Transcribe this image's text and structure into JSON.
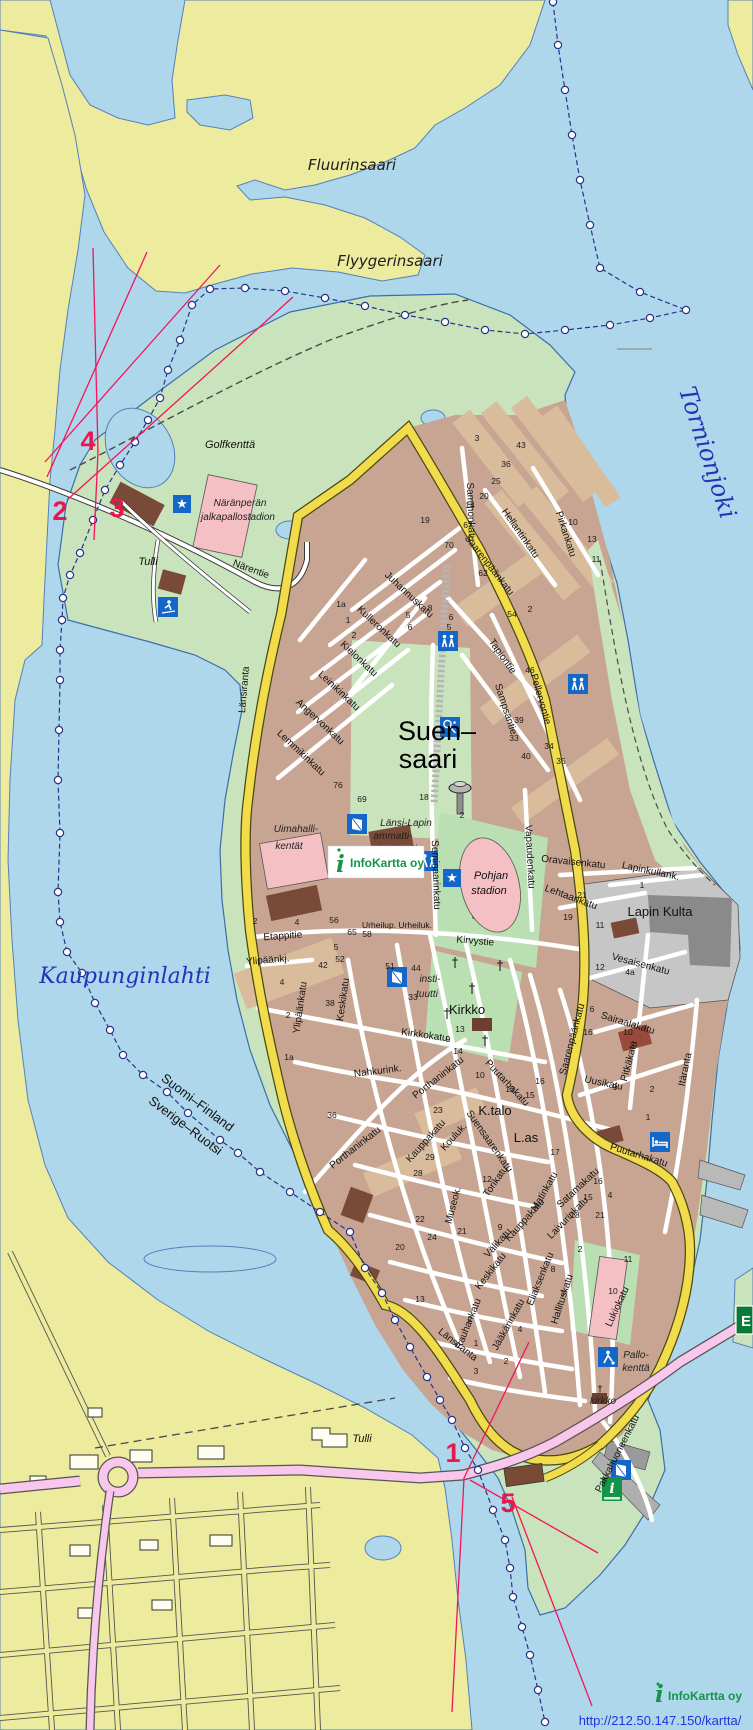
{
  "colors": {
    "water": "#aed7eb",
    "land": "#eceb9e",
    "forest": "#c9e3bd",
    "urban": "#c8a593",
    "urban_tan": "#d9bc9c",
    "building": "#7a4a38",
    "road_yellow": "#f2dc4c",
    "road_pink": "#f9c6ec",
    "marker_magenta": "#e8174f",
    "border_blue": "#27348b",
    "water_label_blue": "#2433b8",
    "logo_green": "#149447",
    "sign_green": "#0a7a38",
    "red_line": "#f4145a",
    "stadium_pink": "#f5c0c4",
    "industry_gray": "#c6c6c6"
  },
  "places": {
    "fluurinsaari": "Fluurinsaari",
    "flyygerinsaari": "Flyygerinsaari",
    "tornionjoki": "Tornionjoki",
    "kaupunginlahti": "Kaupunginlahti",
    "golfkentta": "Golfkenttä",
    "suensaari1": "Suen–",
    "suensaari2": "saari",
    "lapinkulta": "Lapin Kulta",
    "tulli": "Tulli",
    "kirkko": "Kirkko",
    "kirkko_small": "kirkko",
    "kentat1": "Uimahalli-",
    "kentat2": "kentät",
    "naranperan1": "Näränperän",
    "naranperan2": "jalkapallostadion",
    "pohjan1": "Pohjan",
    "pohjan2": "stadion",
    "inst1": "Länsi-Lapin",
    "inst2": "ammatti-",
    "inst3": "instituutti",
    "inst2a": "insti-",
    "inst2b": "tuutti",
    "ktalo": "K.talo",
    "las": "L.as",
    "pallo1": "Pallo-",
    "pallo2": "kenttä"
  },
  "streets": {
    "narentie": "Närentie",
    "sammonkatu": "Sammonkatu",
    "pirkankatu": "Pirkankatu",
    "hellantinkatu": "Hellantinkatu",
    "saarenpaankatu": "Saarenpäänkatu",
    "juhannuskatu": "Juhannuskatu",
    "kulleronkatu": "Kulleronkatu",
    "kielonkatu": "Kielonkatu",
    "leinikinkatu": "Leinikinkatu",
    "angervonkatu": "Angervonkatu",
    "lemmikinkatu": "Lemmikinkatu",
    "lansiranta": "Länsiranta",
    "tapiontie": "Tapiontie",
    "sampsantie": "Sampsantie",
    "pellervontie": "Pellervontie",
    "vapaudenkatu": "Vapaudenkatu",
    "seminaarinkatu": "Seminaarinkatu",
    "oravaisenkatu": "Oravaisenkatu",
    "lapinkullank": "Lapinkullank.",
    "lehtaankatu": "Lehtaankatu",
    "vesaisenkatu": "Vesaisenkatu",
    "sairaalakatu": "Sairaalakatu",
    "pitkakatu": "Pitkäkatu",
    "uusikatu": "Uusikatu",
    "itaranta": "Itäranta",
    "puutarhakatu": "Puutarhakatu",
    "kirvystie": "Kirvystie",
    "etappitie": "Etappitie",
    "ylipaankj": "Ylipäänkj.",
    "ylipaankatu": "Ylipäänkatu",
    "keskikatu": "Keskikatu",
    "kirkkokatu": "Kirkkokatu",
    "nahkurink": "Nahkurink.",
    "porthaninkatu": "Porthaninkatu",
    "kauppakatu": "Kauppakatu",
    "kouluk": "Kouluk.",
    "suensaarenkatu": "Suensaarenkatu",
    "torikatu": "Torikatu",
    "museok": "Museok.",
    "valikatu": "Välikatu",
    "eliaksenkatu": "Eliaksenkatu",
    "hallituskatu": "Hallituskatu",
    "lukiokatu": "Lukiokatu",
    "rauhankatu": "Rauhankatu",
    "jaakarinkatu": "Jääkärinkatu",
    "satamakatu": "Satamakatu",
    "laivurinkatu": "Laivurinkatu",
    "matinkatu": "Matinkatu",
    "pakkahuoneenkatu": "Pakkahuoneenkatu",
    "urheiluk": "Urheilup. Urheiluk."
  },
  "markers": {
    "m1": "1",
    "m2": "2",
    "m3": "3",
    "m4": "4",
    "m5": "5"
  },
  "border": {
    "line1": "Suomi–Finland",
    "line2": "Sverige–Ruotsi"
  },
  "signs": {
    "e_road": "E"
  },
  "logo": {
    "i": "i",
    "name": "InfoKartta oy"
  },
  "footer": {
    "url": "http://212.50.147.150/kartta/"
  },
  "house_numbers": [
    [
      "19",
      425,
      523
    ],
    [
      "67",
      468,
      528
    ],
    [
      "70",
      449,
      548
    ],
    [
      "62",
      483,
      576
    ],
    [
      "14",
      470,
      508
    ],
    [
      "20",
      484,
      499
    ],
    [
      "25",
      496,
      484
    ],
    [
      "36",
      506,
      467
    ],
    [
      "43",
      521,
      448
    ],
    [
      "3",
      477,
      441
    ],
    [
      "13",
      592,
      542
    ],
    [
      "10",
      573,
      525
    ],
    [
      "11",
      596,
      562
    ],
    [
      "2",
      530,
      612
    ],
    [
      "54",
      512,
      617
    ],
    [
      "1a",
      341,
      607
    ],
    [
      "1",
      348,
      623
    ],
    [
      "2",
      354,
      638
    ],
    [
      "5",
      408,
      618
    ],
    [
      "6",
      410,
      630
    ],
    [
      "6",
      451,
      620
    ],
    [
      "5",
      449,
      630
    ],
    [
      "8",
      430,
      611
    ],
    [
      "46",
      530,
      673
    ],
    [
      "39",
      519,
      723
    ],
    [
      "33",
      514,
      741
    ],
    [
      "40",
      526,
      759
    ],
    [
      "34",
      549,
      749
    ],
    [
      "35",
      561,
      764
    ],
    [
      "76",
      338,
      788
    ],
    [
      "69",
      362,
      802
    ],
    [
      "18",
      424,
      800
    ],
    [
      "2",
      462,
      818
    ],
    [
      "56",
      334,
      923
    ],
    [
      "65",
      352,
      935
    ],
    [
      "58",
      367,
      937
    ],
    [
      "52",
      340,
      962
    ],
    [
      "5",
      336,
      950
    ],
    [
      "42",
      323,
      968
    ],
    [
      "51",
      390,
      969
    ],
    [
      "44",
      416,
      971
    ],
    [
      "33",
      413,
      1000
    ],
    [
      "38",
      330,
      1006
    ],
    [
      "4",
      282,
      985
    ],
    [
      "2",
      288,
      1018
    ],
    [
      "1a",
      289,
      1060
    ],
    [
      "2",
      255,
      924
    ],
    [
      "4",
      297,
      925
    ],
    [
      "36",
      332,
      1118
    ],
    [
      "23",
      438,
      1113
    ],
    [
      "13",
      460,
      1032
    ],
    [
      "9",
      448,
      1042
    ],
    [
      "14",
      458,
      1054
    ],
    [
      "12",
      600,
      970
    ],
    [
      "4a",
      630,
      975
    ],
    [
      "16",
      588,
      1035
    ],
    [
      "10",
      628,
      1035
    ],
    [
      "3",
      632,
      1048
    ],
    [
      "6",
      592,
      1012
    ],
    [
      "9",
      615,
      1090
    ],
    [
      "2",
      652,
      1092
    ],
    [
      "1",
      648,
      1120
    ],
    [
      "15",
      530,
      1098
    ],
    [
      "16",
      540,
      1084
    ],
    [
      "12",
      510,
      1092
    ],
    [
      "10",
      480,
      1078
    ],
    [
      "29",
      430,
      1160
    ],
    [
      "28",
      418,
      1176
    ],
    [
      "24",
      432,
      1240
    ],
    [
      "21",
      462,
      1234
    ],
    [
      "20",
      400,
      1250
    ],
    [
      "22",
      420,
      1222
    ],
    [
      "12",
      487,
      1182
    ],
    [
      "9",
      500,
      1230
    ],
    [
      "8",
      553,
      1272
    ],
    [
      "7",
      563,
      1297
    ],
    [
      "2",
      580,
      1252
    ],
    [
      "10",
      613,
      1294
    ],
    [
      "11",
      628,
      1262
    ],
    [
      "18",
      575,
      1218
    ],
    [
      "21",
      600,
      1218
    ],
    [
      "15",
      588,
      1200
    ],
    [
      "16",
      598,
      1184
    ],
    [
      "4",
      610,
      1198
    ],
    [
      "13",
      420,
      1302
    ],
    [
      "2",
      470,
      1322
    ],
    [
      "1",
      476,
      1346
    ],
    [
      "4",
      520,
      1332
    ],
    [
      "3",
      476,
      1374
    ],
    [
      "2",
      506,
      1364
    ],
    [
      "17",
      555,
      1155
    ],
    [
      "19",
      568,
      920
    ],
    [
      "21",
      582,
      898
    ],
    [
      "11",
      600,
      928
    ],
    [
      "1",
      642,
      888
    ]
  ]
}
